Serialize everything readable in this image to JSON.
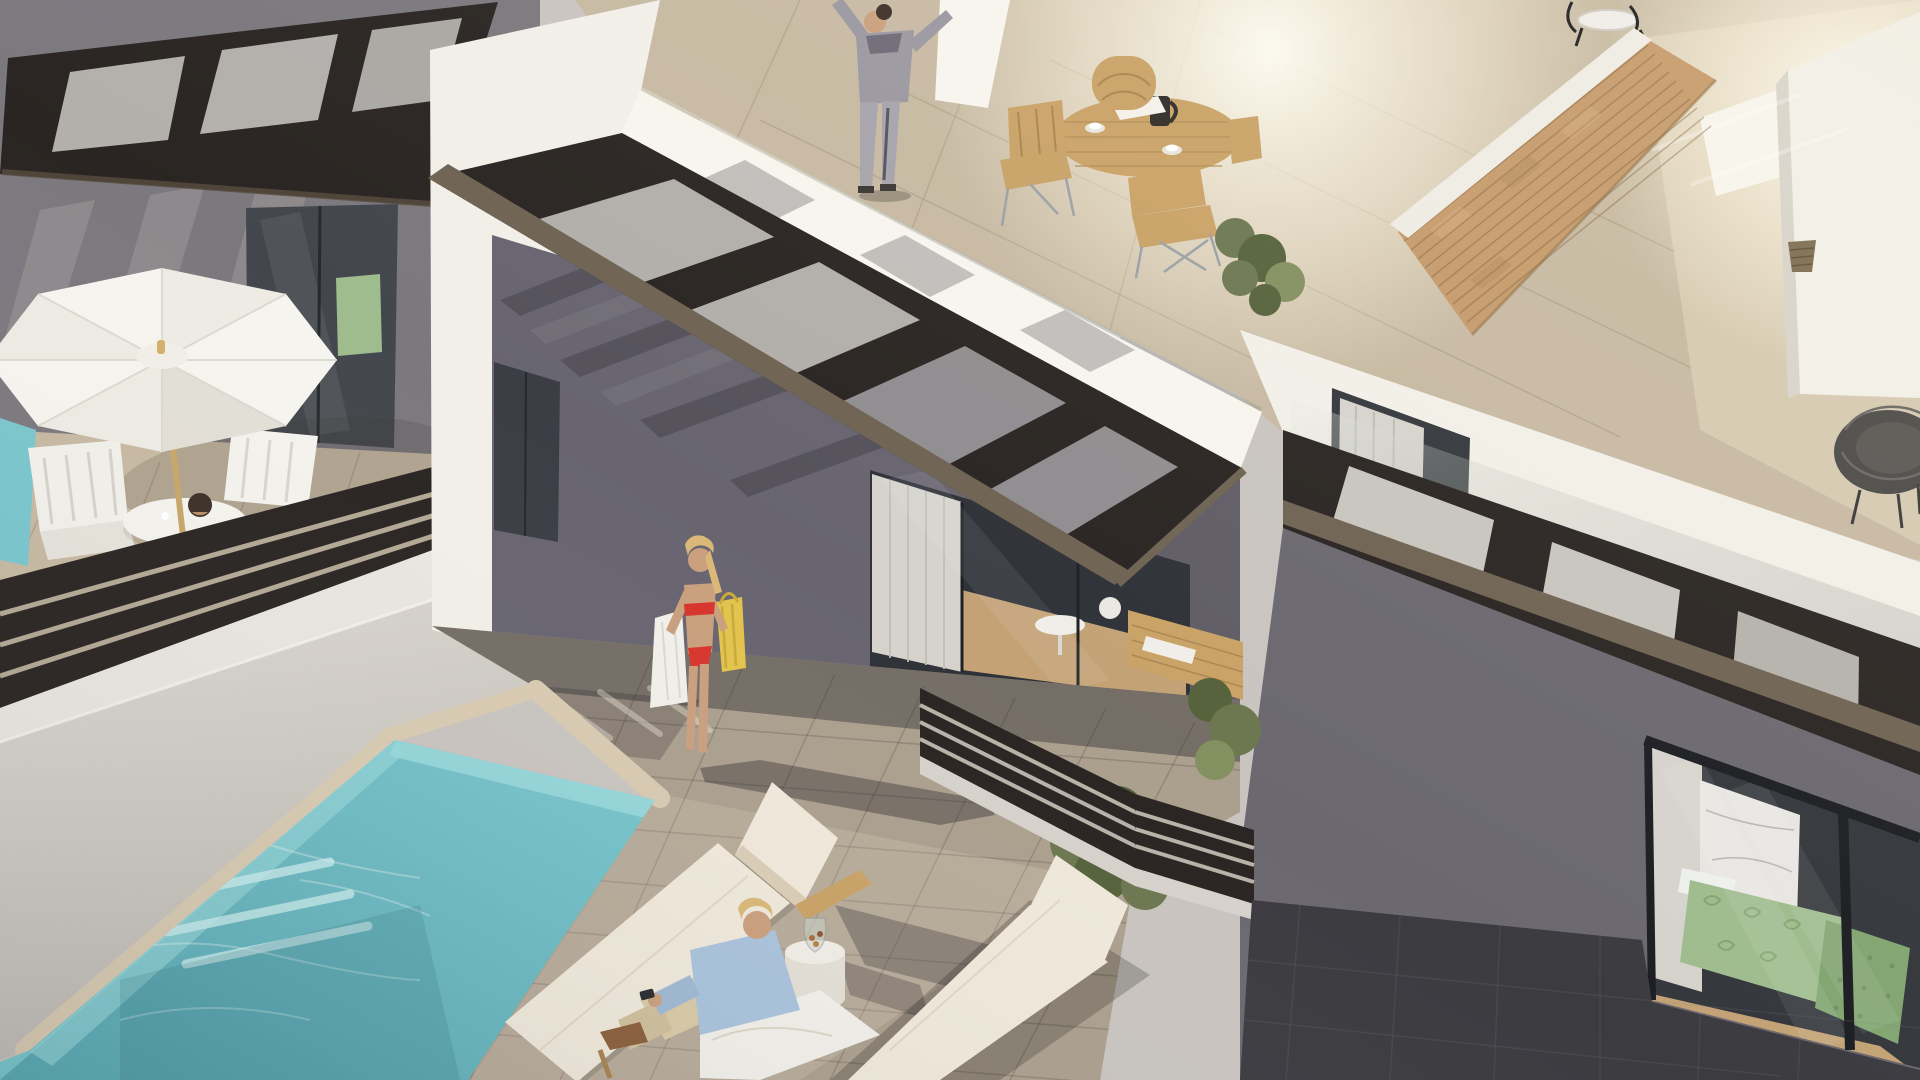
{
  "meta": {
    "title": "Aerial 3D render of modern white terraced villas with private plunge pools on a sunny morning",
    "scene_type": "architectural-visualization",
    "camera": "high-angle aerial view",
    "canvas": {
      "width": 1920,
      "height": 1080
    }
  },
  "palette": {
    "bg": "#c9c4bf",
    "wall_white": "#f2efe8",
    "wall_bright": "#f8f5ee",
    "wall_shadow": "#7b787e",
    "wall_shadow_dark": "#686570",
    "pergola_dark": "#2a2522",
    "pergola_brown": "#6f6353",
    "brick": "#c59a6b",
    "coping": "#d9cbb2",
    "paver_sun": "#ab9f8e",
    "paver_warm": "#c7b9a2",
    "paver_dark": "#3c3b40",
    "pool_water": "#7ac6cd",
    "pool_light": "#9ad8da",
    "umbrella_white": "#f6f4ee",
    "wood": "#c9a266",
    "cushion": "#efe8da",
    "glass_dark": "#34373c",
    "glass_interior": "#2f3238",
    "curtain": "#d6d3cd",
    "interior_wood": "#c4a276",
    "bed_green": "#9fbc8e",
    "bed_green_dark": "#82a571",
    "plant": "#6c7750",
    "plant_dark": "#55623b",
    "plant_light": "#83905f",
    "skin": "#caa07e",
    "hair_blonde": "#d9b878",
    "hair_dark": "#3c3028",
    "bikini_red": "#d7352c",
    "towel_white": "#f1efe9",
    "bag_yellow": "#e3c34c",
    "hoodie_grey": "#9b97a1",
    "shirt_blue": "#aac2dc",
    "khaki": "#d9caa6",
    "rattan": "#4c4a48",
    "marble": "#e8e6e2"
  },
  "scene": {
    "people": [
      {
        "id": "person-stretching",
        "description": "woman in grey hoodie and joggers stretching with raised arms on the upper roof terrace"
      },
      {
        "id": "man-at-table",
        "description": "dark-haired man seated at a white garden table under a white parasol on the left terrace"
      },
      {
        "id": "woman-red-bikini",
        "description": "blonde woman in a red bikini carrying a white towel and yellow straw bag across the pool terrace"
      },
      {
        "id": "man-with-phone",
        "description": "blonde man in a light blue shirt and beige trousers sitting on a floor cushion between two sun loungers, looking at his phone"
      }
    ],
    "left_terrace": {
      "label": "neighbouring terrace",
      "objects": [
        "slatted-pergola",
        "glass-door",
        "white-parasol",
        "white-dining-table",
        "white-garden-chairs",
        "plunge-pool-edge",
        "dark-slat-railing",
        "sand-coloured-tiles"
      ]
    },
    "upper_roof_terrace": {
      "label": "roof terrace",
      "objects": [
        "glass-balustrade",
        "round-wooden-dining-table",
        "wooden-chairs",
        "coffee-press",
        "coffee-cups",
        "newspaper",
        "potted-plant"
      ]
    },
    "main_terrace": {
      "label": "main pool terrace",
      "objects": [
        "private-pool-with-steps",
        "stone-coping",
        "grey-pavers",
        "slatted-pergola",
        "glass-wall-with-dining-interior",
        "two-wooden-sun-loungers",
        "white-drum-side-table",
        "glass-vase",
        "floor-cushion",
        "long-morning-shadows"
      ]
    },
    "right_villa": {
      "label": "right villa",
      "objects": [
        "slatted-pergola",
        "glass-slider",
        "bedroom-with-green-quilted-bed",
        "marble-feature-wall",
        "white-curtain",
        "dark-stone-paving",
        "balcony-slat-railing",
        "shrubs",
        "wood-deck"
      ]
    },
    "upper_right_terrace": {
      "label": "upper right terrace",
      "objects": [
        "sandstone-brick-feature-wall",
        "white-parapets",
        "rattan-lounge-chair",
        "wicker-basket",
        "black-bistro-set",
        "glass-balustrade"
      ]
    }
  }
}
